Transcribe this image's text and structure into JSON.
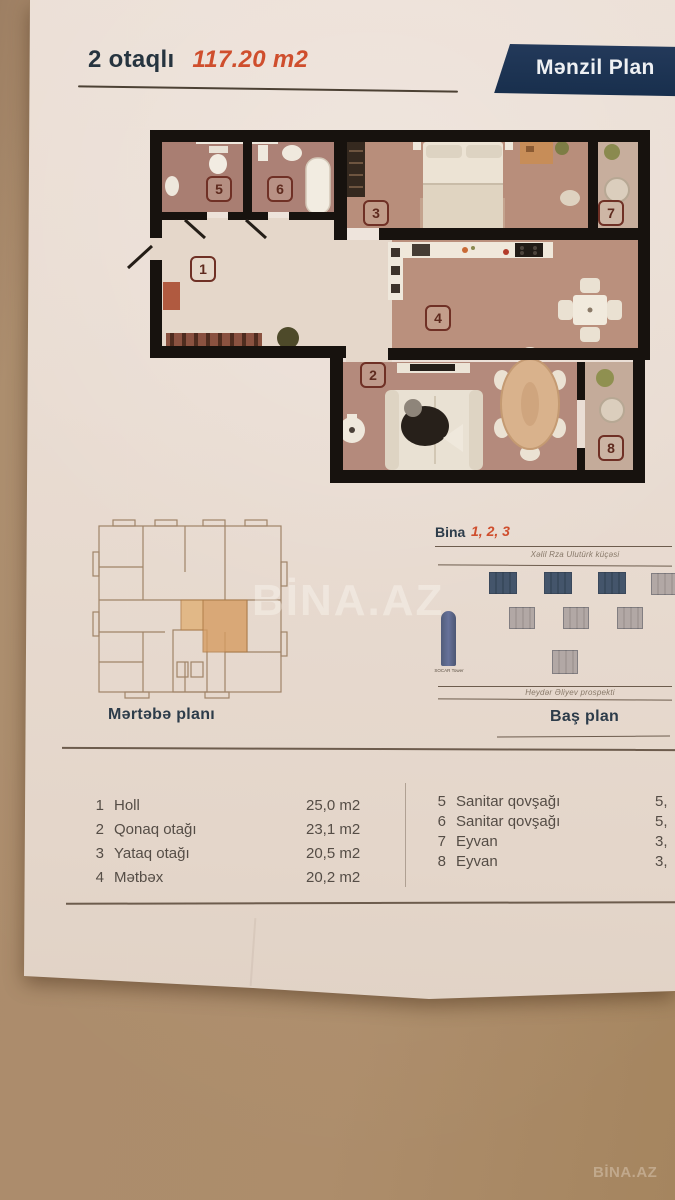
{
  "header": {
    "title": "2 otaqlı",
    "area": "117.20 m2",
    "banner": "Mənzil Plan"
  },
  "plan": {
    "room_numbers": [
      "1",
      "2",
      "3",
      "4",
      "5",
      "6",
      "7",
      "8"
    ]
  },
  "floor_plate": {
    "label": "Mərtəbə planı"
  },
  "site_plan": {
    "bina": "Bina",
    "bina_numbers": "1, 2, 3",
    "street_top": "Xəlil Rza Ulutürk küçəsi",
    "tower": "SOCAR Tower",
    "street_bottom": "Heydər Əliyev prospekti",
    "label": "Baş plan"
  },
  "legend": {
    "left": [
      {
        "num": "1",
        "name": "Holl",
        "area": "25,0 m2"
      },
      {
        "num": "2",
        "name": "Qonaq otağı",
        "area": "23,1 m2"
      },
      {
        "num": "3",
        "name": "Yataq otağı",
        "area": "20,5 m2"
      },
      {
        "num": "4",
        "name": "Mətbəx",
        "area": "20,2 m2"
      }
    ],
    "right": [
      {
        "num": "5",
        "name": "Sanitar qovşağı",
        "area": "5,"
      },
      {
        "num": "6",
        "name": "Sanitar qovşağı",
        "area": "5,"
      },
      {
        "num": "7",
        "name": "Eyvan",
        "area": "3,"
      },
      {
        "num": "8",
        "name": "Eyvan",
        "area": "3,"
      }
    ]
  },
  "watermarks": {
    "center": "BİNA.AZ",
    "corner": "BİNA.AZ"
  }
}
